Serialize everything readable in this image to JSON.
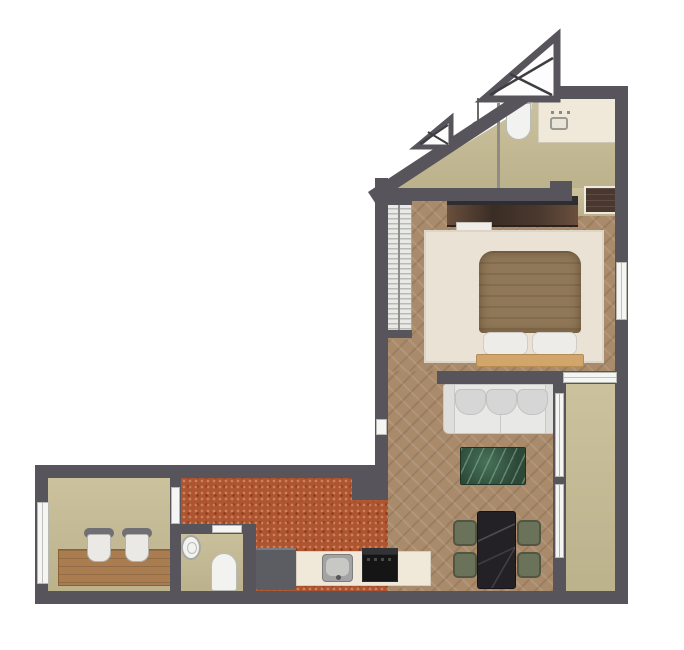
{
  "meta": {
    "type": "architectural-floor-plan",
    "view": "top-down 3d render",
    "shape": "L-shaped apartment with diagonal roof-truss corner"
  },
  "colors": {
    "background": "#ffffff",
    "wall": "#57545b",
    "wall_dark_accent": "#3f3d42",
    "khaki_floor": "#c7bd95",
    "wood_floor": "#a98a6b",
    "terracotta_floor": "#ae5530",
    "rug": "#e9e2d5",
    "sofa": "#e8e8e7",
    "sofa_cushion": "#d6d6d7",
    "duvet": "#8f7757",
    "pillow": "#edece8",
    "bed_frame": "#d2a56b",
    "console_wood": "#4a382e",
    "desk_wood": "#aa7d51",
    "coffee_table_marble": "#2c4937",
    "dining_table_marble": "#232126",
    "dining_chair": "#6a7259",
    "counter": "#f0e9da",
    "appliance_dark": "#151515",
    "cabinet_gray": "#5c5c63",
    "fixture_white": "#f2f2f0",
    "window_white": "#f5f5f3",
    "radiator": "#e9e9e7",
    "truss_fill": "#fdfdfd"
  },
  "rooms": [
    {
      "id": "bathroom",
      "location": "top, under diagonal wall",
      "floor": "khaki"
    },
    {
      "id": "bedroom",
      "location": "upper middle",
      "floor": "herringbone wood"
    },
    {
      "id": "living-room",
      "location": "lower right of main section",
      "floor": "herringbone wood"
    },
    {
      "id": "balcony",
      "location": "right edge beside living room",
      "floor": "khaki"
    },
    {
      "id": "kitchen",
      "location": "bottom wing, right part",
      "floor": "terracotta"
    },
    {
      "id": "wc",
      "location": "bottom wing, middle",
      "floor": "khaki"
    },
    {
      "id": "study",
      "location": "bottom wing, left end",
      "floor": "khaki"
    }
  ],
  "furniture": [
    {
      "room": "bathroom",
      "items": [
        "shower-head",
        "toilet",
        "vanity-sink",
        "glass-partition",
        "top-window"
      ]
    },
    {
      "room": "bedroom",
      "items": [
        "radiator",
        "wood-console",
        "half-round-chair",
        "area-rug",
        "double-bed-duvet",
        "two-pillows",
        "bed-frame",
        "closet",
        "side-window"
      ]
    },
    {
      "room": "living-room",
      "items": [
        "three-seat-sofa",
        "green-marble-coffee-table",
        "black-marble-dining-table",
        "four-dining-chairs"
      ]
    },
    {
      "room": "kitchen",
      "items": [
        "tall-cabinet",
        "counter",
        "kitchen-sink",
        "cooktop"
      ]
    },
    {
      "room": "wc",
      "items": [
        "round-basin",
        "toilet",
        "door"
      ]
    },
    {
      "room": "study",
      "items": [
        "wood-desk",
        "two-chairs",
        "side-window",
        "door"
      ]
    },
    {
      "room": "exterior",
      "items": [
        "large-roof-truss",
        "small-roof-truss",
        "diagonal-wall"
      ]
    }
  ]
}
